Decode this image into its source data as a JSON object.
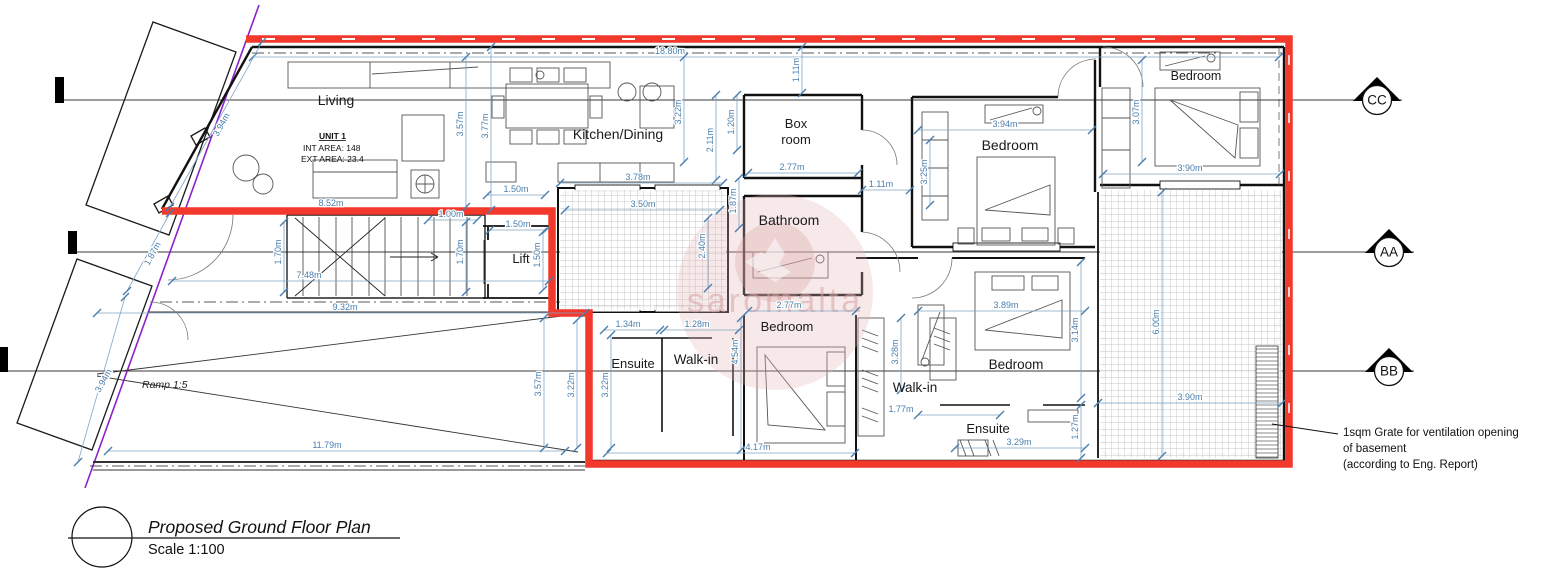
{
  "colors": {
    "unit_outline": "#f2392c",
    "dimension": "#4a7eae",
    "site_boundary": "#8c22cc"
  },
  "title_block": {
    "title": "Proposed Ground Floor Plan",
    "scale": "Scale 1:100"
  },
  "unit_info": {
    "name": "UNIT 1",
    "int_area": "INT AREA: 148",
    "ext_area": "EXT AREA: 23.4"
  },
  "annotations": {
    "ramp": "Ramp 1:5",
    "watermark": "saromalta",
    "note_line1": "1sqm Grate for ventilation opening",
    "note_line2": "of basement",
    "note_line3": "(according to Eng. Report)"
  },
  "section_markers": [
    {
      "label": "CC",
      "x": 1377,
      "y": 100
    },
    {
      "label": "AA",
      "x": 1389,
      "y": 252
    },
    {
      "label": "BB",
      "x": 1389,
      "y": 371
    }
  ],
  "room_labels": [
    {
      "label": "Living",
      "x": 336,
      "y": 105,
      "size": 14,
      "color": "#1a1a1a"
    },
    {
      "label": "Kitchen/Dining",
      "x": 618,
      "y": 139,
      "size": 14,
      "color": "#1a1a1a"
    },
    {
      "label": "Box",
      "x": 796,
      "y": 128,
      "size": 13,
      "color": "#1a1a1a"
    },
    {
      "label": "room",
      "x": 796,
      "y": 144,
      "size": 13,
      "color": "#1a1a1a"
    },
    {
      "label": "Bathroom",
      "x": 789,
      "y": 225,
      "size": 14,
      "color": "#433"
    },
    {
      "label": "Bedroom",
      "x": 1010,
      "y": 150,
      "size": 14,
      "color": "#1a1a1a"
    },
    {
      "label": "Bedroom",
      "x": 1196,
      "y": 80,
      "size": 12.5,
      "color": "#1a1a1a"
    },
    {
      "label": "Lift",
      "x": 521,
      "y": 263,
      "size": 13,
      "color": "#1a1a1a"
    },
    {
      "label": "Ensuite",
      "x": 633,
      "y": 368,
      "size": 13,
      "color": "#1a1a1a"
    },
    {
      "label": "Walk-in",
      "x": 696,
      "y": 364,
      "size": 13.5,
      "color": "#1a1a1a"
    },
    {
      "label": "Bedroom",
      "x": 787,
      "y": 331,
      "size": 13,
      "color": "#777777"
    },
    {
      "label": "Walk-in",
      "x": 915,
      "y": 392,
      "size": 13.5,
      "color": "#1a1a1a"
    },
    {
      "label": "Bedroom",
      "x": 1016,
      "y": 369,
      "size": 13.5,
      "color": "#1a1a1a"
    },
    {
      "label": "Ensuite",
      "x": 988,
      "y": 433,
      "size": 13,
      "color": "#1a1a1a"
    }
  ],
  "dimensions": [
    {
      "label": "18.80m",
      "x": 670,
      "y": 54,
      "rot": 0,
      "line": [
        253,
        57,
        1279,
        57
      ]
    },
    {
      "label": "1.11m",
      "x": 799,
      "y": 70,
      "rot": -90,
      "line": [
        802,
        47,
        802,
        93
      ]
    },
    {
      "label": "3.57m",
      "x": 463,
      "y": 124,
      "rot": -90,
      "line": [
        466,
        57,
        466,
        207
      ]
    },
    {
      "label": "3.77m",
      "x": 488,
      "y": 126,
      "rot": -90,
      "line": [
        491,
        47,
        491,
        210
      ]
    },
    {
      "label": "3.22m",
      "x": 681,
      "y": 112,
      "rot": -90,
      "line": [
        684,
        57,
        684,
        162
      ]
    },
    {
      "label": "2.11m",
      "x": 713,
      "y": 140,
      "rot": -90,
      "line": [
        716,
        95,
        716,
        180
      ]
    },
    {
      "label": "1.20m",
      "x": 734,
      "y": 122,
      "rot": -90,
      "line": [
        737,
        95,
        737,
        150
      ]
    },
    {
      "label": "3.94m",
      "x": 1005,
      "y": 127,
      "rot": 0,
      "line": [
        918,
        130,
        1092,
        130
      ]
    },
    {
      "label": "3.25m",
      "x": 927,
      "y": 172,
      "rot": -90,
      "line": [
        930,
        140,
        930,
        205
      ]
    },
    {
      "label": "3.07m",
      "x": 1139,
      "y": 112,
      "rot": -90,
      "line": [
        1142,
        60,
        1142,
        162
      ]
    },
    {
      "label": "3.90m",
      "x": 1190,
      "y": 171,
      "rot": 0,
      "line": [
        1103,
        174,
        1280,
        174
      ]
    },
    {
      "label": "2.77m",
      "x": 792,
      "y": 170,
      "rot": 0,
      "line": [
        748,
        173,
        858,
        173
      ]
    },
    {
      "label": "1.11m",
      "x": 881,
      "y": 187,
      "rot": 0,
      "line": [
        862,
        190,
        910,
        190
      ]
    },
    {
      "label": "1.87m",
      "x": 736,
      "y": 201,
      "rot": -90,
      "line": [
        739,
        178,
        739,
        228
      ]
    },
    {
      "label": "2.40m",
      "x": 705,
      "y": 246,
      "rot": -90,
      "line": [
        708,
        218,
        708,
        288
      ]
    },
    {
      "label": "3.78m",
      "x": 638,
      "y": 180,
      "rot": 0,
      "line": [
        560,
        183,
        723,
        183
      ]
    },
    {
      "label": "1.50m",
      "x": 516,
      "y": 192,
      "rot": 0,
      "line": [
        487,
        195,
        545,
        195
      ]
    },
    {
      "label": "3.50m",
      "x": 643,
      "y": 207,
      "rot": 0,
      "line": [
        565,
        210,
        720,
        210
      ]
    },
    {
      "label": "8.52m",
      "x": 331,
      "y": 206,
      "rot": 0
    },
    {
      "label": "1.00m",
      "x": 451,
      "y": 217,
      "rot": 0,
      "line": [
        428,
        220,
        477,
        220
      ]
    },
    {
      "label": "1.50m",
      "x": 518,
      "y": 227,
      "rot": 0,
      "line": [
        490,
        230,
        546,
        230
      ]
    },
    {
      "label": "1.70m",
      "x": 281,
      "y": 252,
      "rot": -90,
      "line": [
        284,
        222,
        284,
        292
      ]
    },
    {
      "label": "1.70m",
      "x": 463,
      "y": 252,
      "rot": -90,
      "line": [
        466,
        222,
        466,
        292
      ]
    },
    {
      "label": "1.50m",
      "x": 540,
      "y": 255,
      "rot": -90,
      "line": [
        543,
        232,
        543,
        290
      ]
    },
    {
      "label": "7.48m",
      "x": 309,
      "y": 278,
      "rot": 0,
      "line": [
        172,
        281,
        549,
        281
      ]
    },
    {
      "label": "9.32m",
      "x": 345,
      "y": 310,
      "rot": 0,
      "line": [
        97,
        313,
        585,
        313
      ]
    },
    {
      "label": "3.94m",
      "x": 224,
      "y": 126,
      "rot": -61,
      "line": [
        262,
        42,
        170,
        207
      ]
    },
    {
      "label": "1.87m",
      "x": 155,
      "y": 255,
      "rot": -61,
      "line": [
        170,
        213,
        127,
        291
      ]
    },
    {
      "label": "3.94m",
      "x": 106,
      "y": 382,
      "rot": -61,
      "line": [
        125,
        297,
        78,
        462
      ]
    },
    {
      "label": "11.79m",
      "x": 327,
      "y": 448,
      "rot": 0,
      "line": [
        108,
        451,
        565,
        451
      ]
    },
    {
      "label": "3.57m",
      "x": 541,
      "y": 384,
      "rot": -90,
      "line": [
        544,
        318,
        544,
        448
      ]
    },
    {
      "label": "3.22m",
      "x": 574,
      "y": 385,
      "rot": -90,
      "line": [
        577,
        320,
        577,
        448
      ]
    },
    {
      "label": "3.22m",
      "x": 608,
      "y": 385,
      "rot": -90,
      "line": [
        611,
        335,
        611,
        448
      ]
    },
    {
      "label": "1.34m",
      "x": 628,
      "y": 327,
      "rot": 0,
      "line": [
        604,
        330,
        660,
        330
      ]
    },
    {
      "label": "1.28m",
      "x": 697,
      "y": 327,
      "rot": 0,
      "line": [
        664,
        330,
        739,
        330
      ]
    },
    {
      "label": "4.54m",
      "x": 738,
      "y": 352,
      "rot": -90,
      "line": [
        741,
        318,
        741,
        450
      ]
    },
    {
      "label": "4.17m",
      "x": 758,
      "y": 450,
      "rot": 0,
      "line": [
        607,
        453,
        855,
        453
      ]
    },
    {
      "label": "2.77m",
      "x": 789,
      "y": 308,
      "rot": 0,
      "line": [
        748,
        311,
        856,
        311
      ]
    },
    {
      "label": "3.89m",
      "x": 1006,
      "y": 308,
      "rot": 0,
      "line": [
        918,
        311,
        1085,
        311
      ]
    },
    {
      "label": "3.28m",
      "x": 898,
      "y": 352,
      "rot": -90,
      "line": [
        901,
        318,
        901,
        390
      ]
    },
    {
      "label": "1.77m",
      "x": 901,
      "y": 412,
      "rot": 0,
      "line": [
        918,
        415,
        1000,
        415
      ]
    },
    {
      "label": "3.14m",
      "x": 1078,
      "y": 330,
      "rot": -90,
      "line": [
        1081,
        262,
        1081,
        398
      ]
    },
    {
      "label": "1.27m",
      "x": 1078,
      "y": 427,
      "rot": -90,
      "line": [
        1081,
        405,
        1081,
        458
      ]
    },
    {
      "label": "3.29m",
      "x": 1019,
      "y": 445,
      "rot": 0,
      "line": [
        955,
        448,
        1085,
        448
      ]
    },
    {
      "label": "6.00m",
      "x": 1159,
      "y": 322,
      "rot": -90,
      "line": [
        1162,
        192,
        1162,
        456
      ]
    },
    {
      "label": "3.90m",
      "x": 1190,
      "y": 400,
      "rot": 0,
      "line": [
        1098,
        403,
        1282,
        403
      ]
    }
  ]
}
